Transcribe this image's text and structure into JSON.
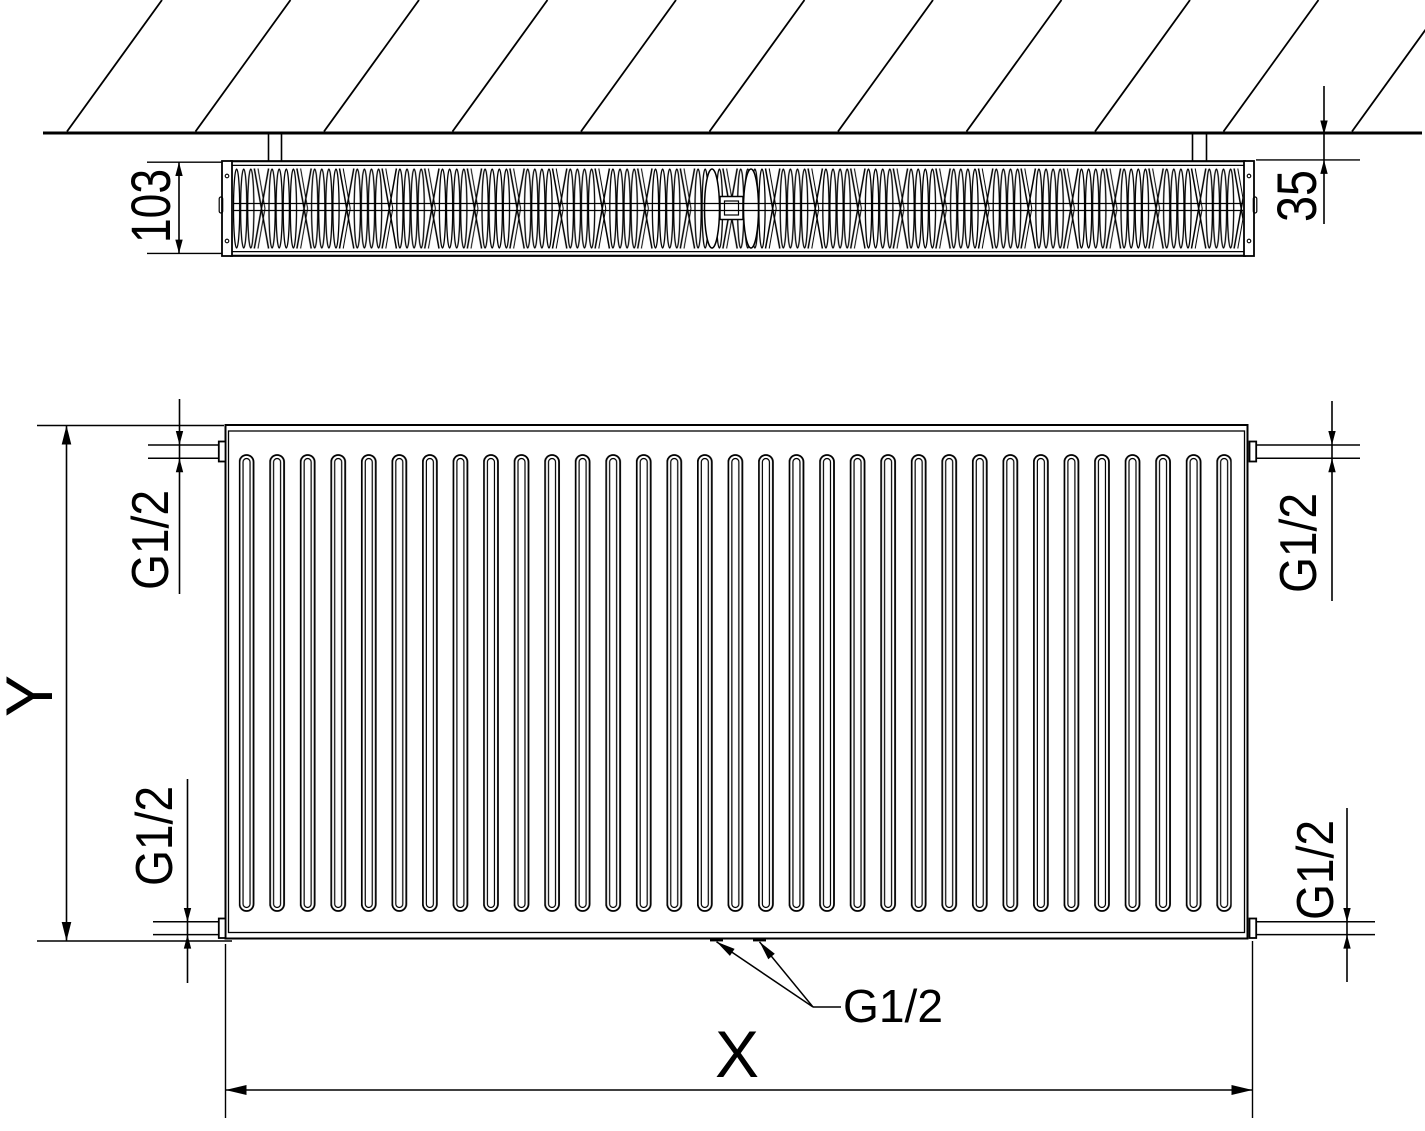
{
  "page": {
    "background": "#ffffff",
    "line_color": "#000000",
    "description_labels": {
      "top_view_depth": "103",
      "top_view_wall_distance": "35"
    }
  },
  "top_view": {
    "depth_dimension": "103",
    "wall_distance_dimension": "35"
  },
  "front_view": {
    "height_dimension": "Y",
    "width_dimension": "X",
    "connection_top_left": "G1/2",
    "connection_top_right": "G1/2",
    "connection_bottom_left": "G1/2",
    "connection_bottom_right": "G1/2",
    "connection_bottom_center": "G1/2"
  }
}
